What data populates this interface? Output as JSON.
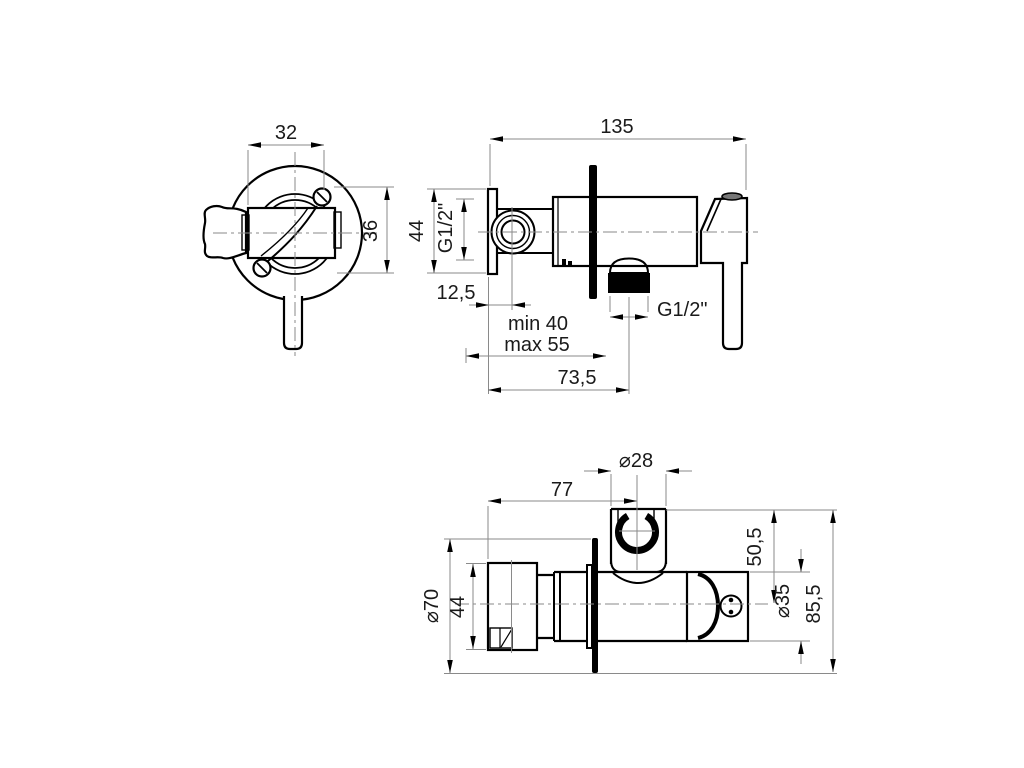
{
  "drawing": {
    "background_color": "#ffffff",
    "object_line_color": "#000000",
    "dimension_line_color": "#8a8a8a",
    "views": {
      "front": {
        "dimensions": {
          "width": "32",
          "height": "36"
        }
      },
      "side": {
        "dimensions": {
          "overall_length": "135",
          "plate_height": "44",
          "inlet_thread": "G1/2\"",
          "inlet_offset": "12,5",
          "depth_min": "min 40",
          "depth_max": "max 55",
          "outlet_offset": "73,5",
          "outlet_thread": "G1/2\""
        }
      },
      "top": {
        "dimensions": {
          "holder_diameter": "⌀28",
          "holder_distance": "77",
          "plate_diameter": "⌀70",
          "handle_width": "44",
          "holder_center_height": "50,5",
          "body_diameter": "⌀35",
          "overall_height": "85,5"
        }
      }
    }
  }
}
